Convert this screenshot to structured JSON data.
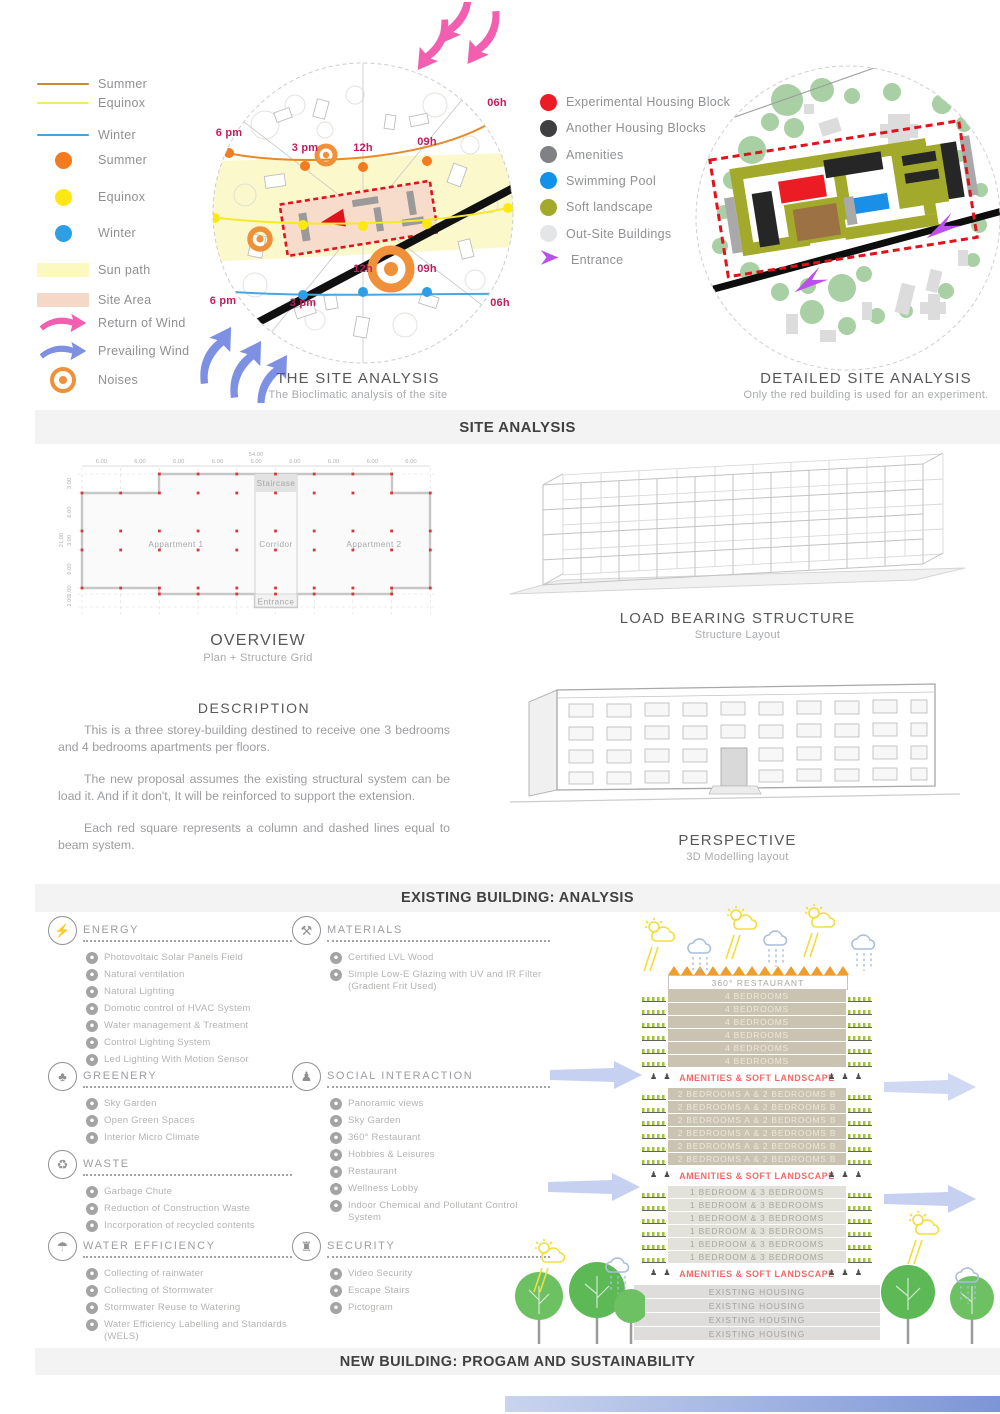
{
  "site_analysis": {
    "band": "SITE ANALYSIS",
    "legend_left": {
      "items": [
        {
          "type": "line",
          "label": "Summer",
          "color": "#c78a3b",
          "icon": "summer-line"
        },
        {
          "type": "line",
          "label": "Equinox",
          "color": "#f0ea6c",
          "icon": "equinox-line"
        },
        {
          "type": "line",
          "label": "Winter",
          "color": "#45a3d9",
          "icon": "winter-line"
        },
        {
          "type": "dot",
          "label": "Summer",
          "color": "#f47b20",
          "icon": "summer-sun-dot"
        },
        {
          "type": "dot",
          "label": "Equinox",
          "color": "#ffe714",
          "icon": "equinox-sun-dot"
        },
        {
          "type": "dot",
          "label": "Winter",
          "color": "#2e9fe5",
          "icon": "winter-sun-dot"
        },
        {
          "type": "swatch",
          "label": "Sun path",
          "color": "#fbf8c0",
          "icon": "sun-path-swatch"
        },
        {
          "type": "swatch",
          "label": "Site Area",
          "color": "#f6d8c8",
          "icon": "site-area-swatch"
        },
        {
          "type": "arrow",
          "label": "Return of Wind",
          "color": "#f25fb0",
          "icon": "return-wind-arrow"
        },
        {
          "type": "arrow",
          "label": "Prevailing Wind",
          "color": "#7d90e2",
          "icon": "prevailing-wind-arrow"
        },
        {
          "type": "noises",
          "label": "Noises",
          "color": "#f0913a",
          "icon": "noises-ring"
        }
      ]
    },
    "bioclimatic": {
      "title": "THE SITE ANALYSIS",
      "subtitle": "The Bioclimatic analysis of the site",
      "times_top": [
        "6 pm",
        "3 pm",
        "12h",
        "09h",
        "06h"
      ],
      "times_bottom": [
        "6 pm",
        "3 pm",
        "12h",
        "09h",
        "06h"
      ]
    },
    "legend_right": {
      "items": [
        {
          "type": "dot",
          "label": "Experimental Housing Block",
          "color": "#ec1c24"
        },
        {
          "type": "dot",
          "label": "Another Housing Blocks",
          "color": "#3f3f41"
        },
        {
          "type": "dot",
          "label": "Amenities",
          "color": "#808184"
        },
        {
          "type": "dot",
          "label": "Swimming Pool",
          "color": "#1191e9"
        },
        {
          "type": "dot",
          "label": "Soft landscape",
          "color": "#a3aa2b"
        },
        {
          "type": "dot",
          "label": "Out-Site Buildings",
          "color": "#e4e5e7"
        },
        {
          "type": "arrow",
          "label": "Entrance",
          "color": "#bb50ec"
        }
      ]
    },
    "detailed": {
      "title": "DETAILED SITE ANALYSIS",
      "subtitle": "Only the red building is used for an experiment."
    }
  },
  "existing_building": {
    "band": "EXISTING BUILDING: ANALYSIS",
    "overview": {
      "title": "OVERVIEW",
      "subtitle": "Plan + Structure Grid",
      "dims": {
        "top_total": "54.00",
        "top": [
          "6.00",
          "6.00",
          "6.00",
          "6.00",
          "6.00",
          "6.00",
          "6.00",
          "6.00",
          "6.00"
        ],
        "left_total": "21.00",
        "left": [
          "3.00",
          "6.00",
          "3.00",
          "6.00",
          "1.00",
          "2.00"
        ]
      },
      "rooms": {
        "staircase": "Staircase",
        "apartment1": "Appartment 1",
        "corridor": "Corridor",
        "apartment2": "Appartment 2",
        "entrance": "Entrance"
      }
    },
    "load_bearing": {
      "title": "LOAD BEARING STRUCTURE",
      "subtitle": "Structure Layout"
    },
    "description": {
      "title": "DESCRIPTION",
      "paragraphs": [
        "This is a three storey-building destined to receive one 3 bedrooms and 4 bedrooms apartments per floors.",
        "The new proposal assumes the existing structural system can be load it. And if it don't, It will be reinforced to support the extension.",
        "Each red square represents a column and dashed lines equal to beam system."
      ]
    },
    "perspective": {
      "title": "PERSPECTIVE",
      "subtitle": "3D Modelling layout"
    }
  },
  "new_building": {
    "band": "NEW BUILDING: PROGAM AND SUSTAINABILITY",
    "categories": [
      {
        "title": "ENERGY",
        "icon": "bulb-icon",
        "glyph": "⚡",
        "items": [
          "Photovoltaic Solar Panels Field",
          "Natural ventilation",
          "Natural Lighting",
          "Domotic control of HVAC System",
          "Water management & Treatment",
          "Control Lighting System",
          "Led Lighting With Motion Sensor"
        ]
      },
      {
        "title": "GREENERY",
        "icon": "trees-icon",
        "glyph": "♣",
        "items": [
          "Sky Garden",
          "Open Green Spaces",
          "Interior Micro Climate"
        ]
      },
      {
        "title": "WASTE",
        "icon": "recycle-icon",
        "glyph": "♻",
        "items": [
          "Garbage Chute",
          "Reduction of Construction Waste",
          "Incorporation of recycled contents"
        ]
      },
      {
        "title": "WATER EFFICIENCY",
        "icon": "water-drops-icon",
        "glyph": "☂",
        "items": [
          "Collecting of rainwater",
          "Collecting of Stormwater",
          "Stormwater Reuse to Watering",
          "Water Efficiency Labelling and Standards (WELS)"
        ]
      },
      {
        "title": "MATERIALS",
        "icon": "tools-icon",
        "glyph": "⚒",
        "items": [
          "Certified LVL Wood",
          "Simple Low-E Glazing with UV and IR Filter (Gradient Frit Used)"
        ]
      },
      {
        "title": "SOCIAL INTERACTION",
        "icon": "people-icon",
        "glyph": "♟",
        "items": [
          "Panoramic views",
          "Sky Garden",
          "360° Restaurant",
          "Hobbies & Leisures",
          "Restaurant",
          "Wellness Lobby",
          "Indoor Chemical and Pollutant Control System"
        ]
      },
      {
        "title": "SECURITY",
        "icon": "guard-icon",
        "glyph": "♜",
        "items": [
          "Video Security",
          "Escape Stairs",
          "Pictogram"
        ]
      }
    ],
    "stack": {
      "roof_label": "360° RESTAURANT",
      "amenity_label": "AMENITIES & SOFT LANDSCAPE",
      "sections": [
        {
          "type": "unit",
          "style": "tan",
          "label": "4 BEDROOMS",
          "count": 6
        },
        {
          "type": "amenity"
        },
        {
          "type": "unit",
          "style": "tan",
          "label": "2 BEDROOMS A & 2 BEDROOMS B",
          "count": 6
        },
        {
          "type": "amenity"
        },
        {
          "type": "unit",
          "style": "light",
          "label": "1 BEDROOM & 3 BEDROOMS",
          "count": 6
        },
        {
          "type": "amenity"
        },
        {
          "type": "existing",
          "label": "EXISTING HOUSING",
          "count": 4
        }
      ]
    }
  }
}
